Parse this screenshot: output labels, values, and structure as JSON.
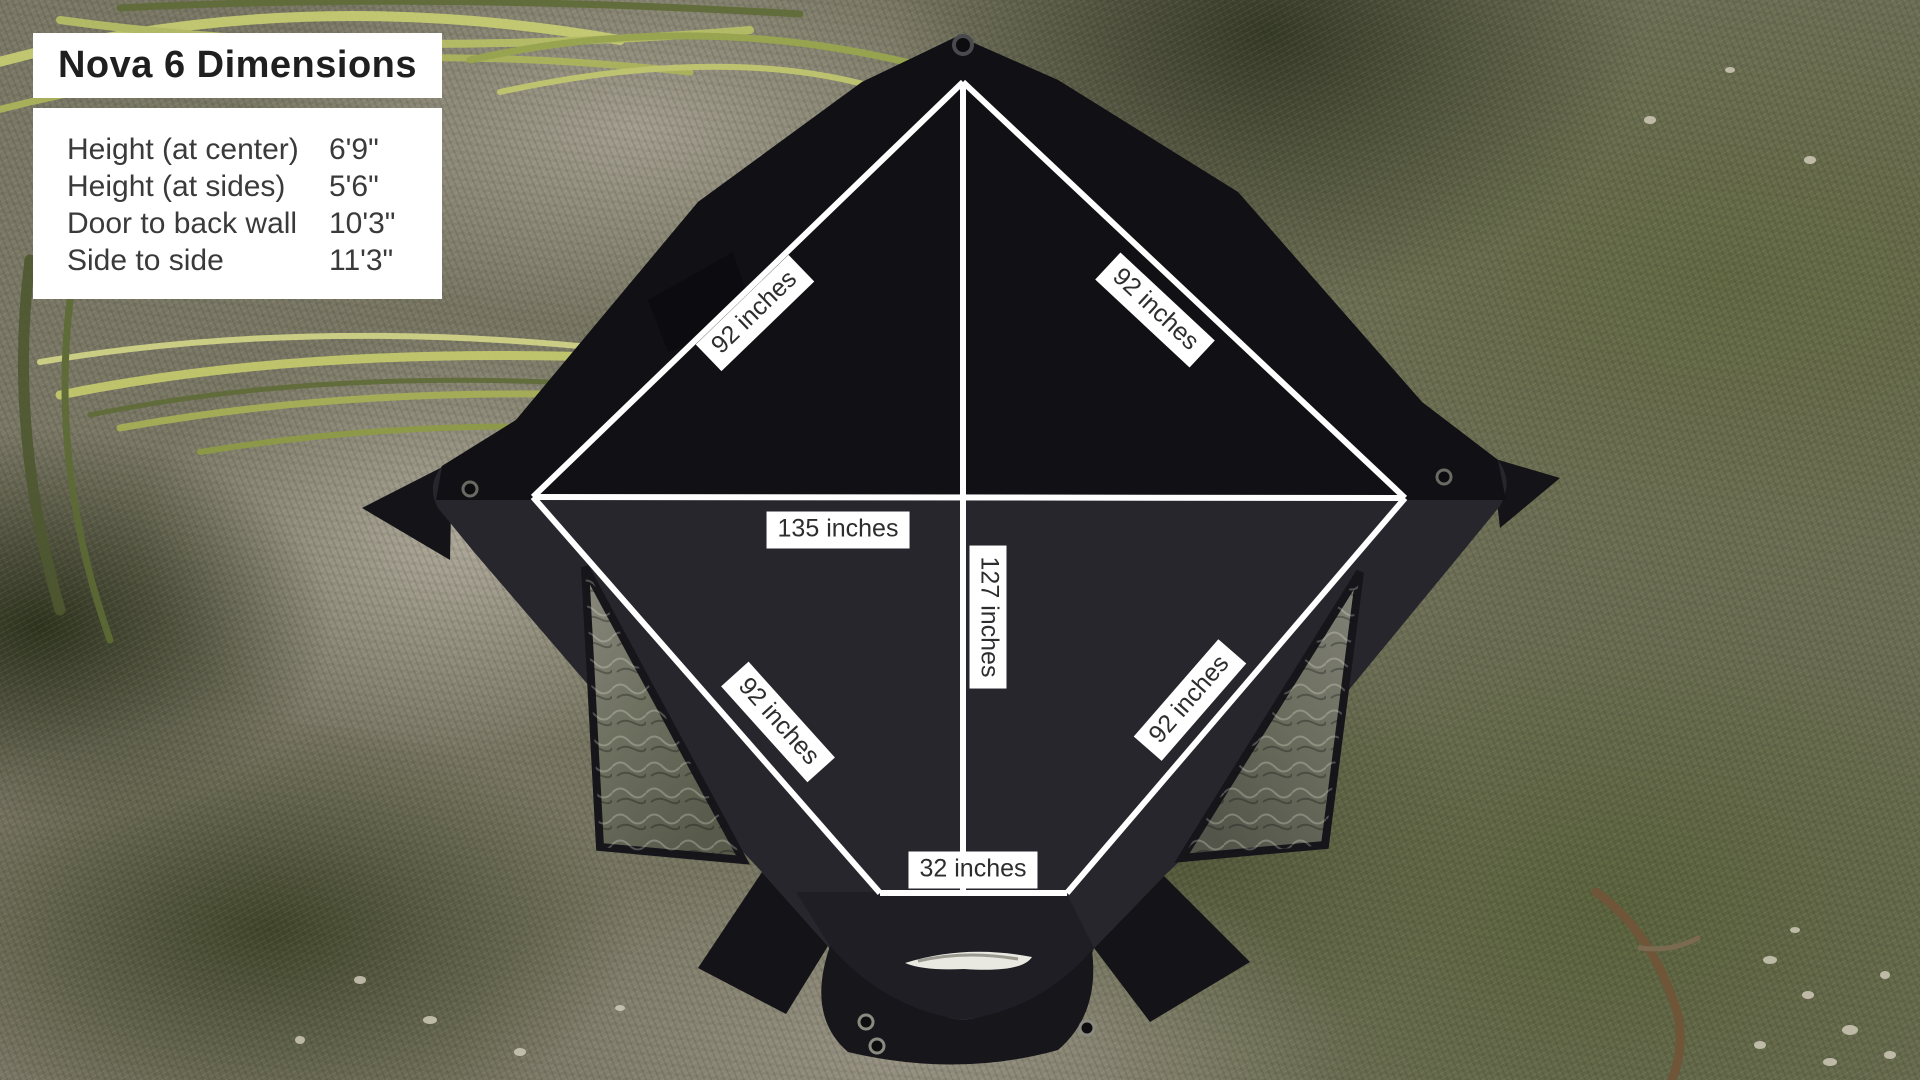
{
  "product": "Nova 6",
  "panel": {
    "title": "Nova 6 Dimensions",
    "rows": [
      {
        "label": "Height (at center)",
        "value": "6'9\""
      },
      {
        "label": "Height (at sides)",
        "value": "5'6\""
      },
      {
        "label": "Door to back wall",
        "value": "10'3\""
      },
      {
        "label": "Side to side",
        "value": "11'3\""
      }
    ]
  },
  "measurements": {
    "top_left_edge": "92 inches",
    "top_right_edge": "92 inches",
    "bottom_left_edge": "92 inches",
    "bottom_right_edge": "92 inches",
    "side_to_side": "135 inches",
    "door_to_back": "127 inches",
    "door_width": "32 inches"
  },
  "colors": {
    "measure_line": "#ffffff",
    "label_bg": "#ffffff",
    "label_text": "#2d2d2d",
    "tent_fabric": "#26262c",
    "tent_roof_dark": "#111115"
  }
}
